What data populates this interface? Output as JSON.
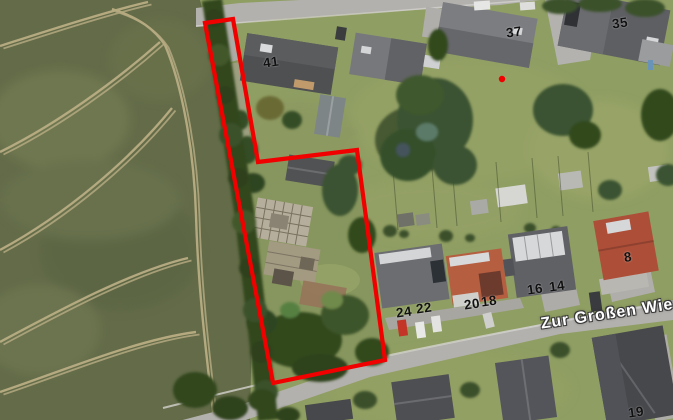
{
  "map": {
    "street_label": "Zur Großen Wies",
    "house_numbers": {
      "n41": "41",
      "n37": "37",
      "n35": "35",
      "n8": "8",
      "n24": "24",
      "n22": "22",
      "n20": "20",
      "n18": "18",
      "n16": "16",
      "n14": "14",
      "n19": "19"
    },
    "colors": {
      "parcel_boundary": "#f10000",
      "marker_dot": "#f10000",
      "house_number_text": "#111111",
      "street_label_text": "#ffffff"
    }
  }
}
